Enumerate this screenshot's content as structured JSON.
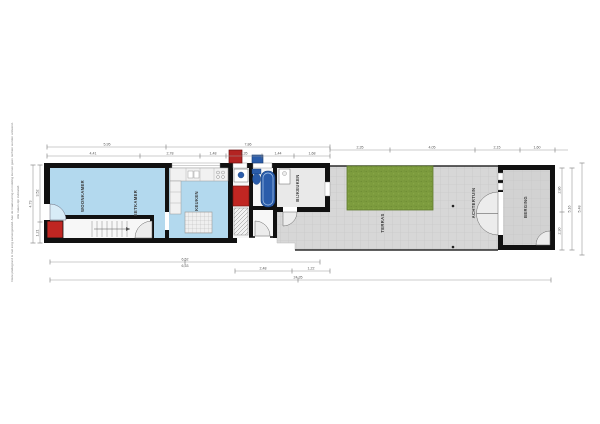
{
  "plan": {
    "title": "floorplan-ground-floor",
    "colors": {
      "floor_blue": "#b3d9ee",
      "fixture_blue": "#2a5caa",
      "accent_red": "#c02622",
      "grass_green": "#7d9c3e",
      "terrace_gray": "#d7d7d7",
      "shed_gray": "#d2d2d2",
      "wall_black": "#111111"
    },
    "rooms": {
      "woonkamer": "WOONKAMER",
      "eetkamer": "EETKAMER",
      "keuken": "KEUKEN",
      "bijkeuken": "BIJKEUKEN",
      "terras": "TERRAS",
      "achtertuin": "ACHTERTUIN",
      "berging": "BERGING"
    },
    "disclaimer": {
      "line1": "Deze plattegrond is met zorg samengesteld. Aan de maatvoering en indeling kunnen geen rechten worden ontleend.",
      "line2": "Alle maten zijn indicatief."
    },
    "dims": {
      "t1": "5,95",
      "t2": "7,86",
      "tr1": "2,35",
      "tr2": "4,05",
      "tr3": "2,15",
      "tr4": "1,60",
      "s1": "4,41",
      "s2": "2,78",
      "s3": "1,48",
      "s4": "1,35",
      "s5": "1,44",
      "s6": "1,68",
      "b1": "6,52",
      "b1b": "6,53",
      "b2": "2,48",
      "b3": "1,22",
      "b4": "24,35",
      "l1": "4,73",
      "l2": "3,52",
      "l3": "1,21",
      "r1": "2,86",
      "r2": "2,30",
      "r3": "5,16",
      "r4": "5,48"
    }
  }
}
